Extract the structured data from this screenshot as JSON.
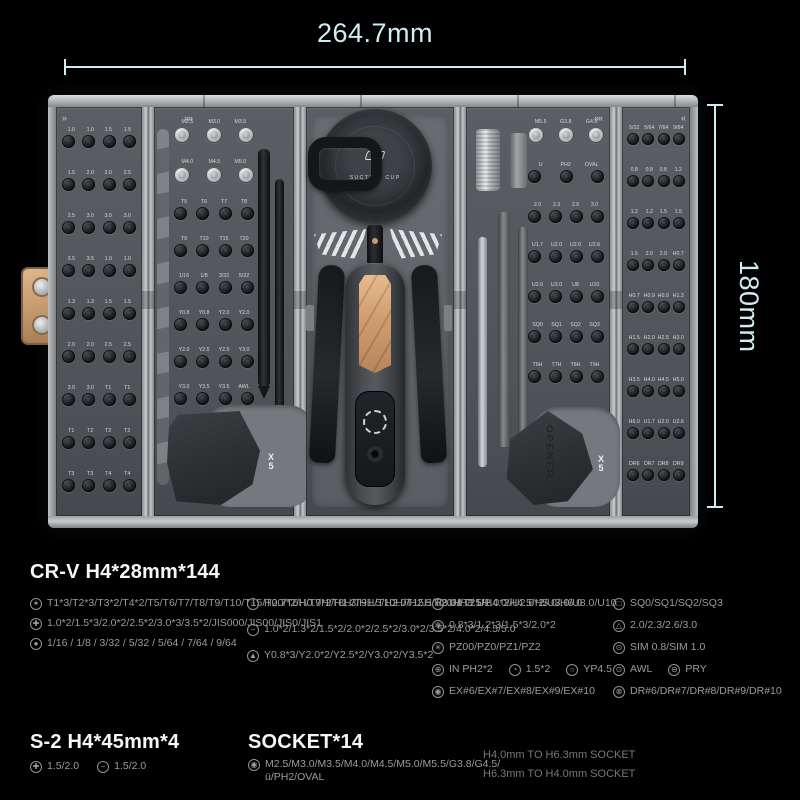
{
  "colors": {
    "accent": "#cfeef2",
    "copper": "#c99a6f",
    "case_gray": "#54585c"
  },
  "annotations": {
    "width_label": "264.7mm",
    "height_label": "180mm"
  },
  "icons": {
    "torx": "✶",
    "phillips": "✚",
    "fraction": "●",
    "hex": "○",
    "slotted": "−",
    "y-type": "▲",
    "u-type": "∪",
    "pentalobe": "✻",
    "pozidriv": "✳",
    "ph-in": "⊕",
    "micro": "◔",
    "yp": "○",
    "external-torx": "◉",
    "square": "□",
    "triangle": "△",
    "sim": "⊙",
    "awl": "⊙",
    "pry": "⊖",
    "dr": "⊗",
    "socket": "◉"
  },
  "case": {
    "marks": {
      "p1": "»",
      "p2": "»»",
      "p4": "««",
      "p5": "«"
    },
    "suction_label": "SUCTION CUP",
    "opener_label": "OPENER",
    "pick_qty": "X5",
    "panel1_rows": [
      "1.0 1.0 1.5 1.5",
      "1.5 2.0 2.0 2.5",
      "2.5 3.0 3.0 3.0",
      "3.5 3.5 1.0 1.0",
      "1.3 1.3 1.5 1.5",
      "2.0 2.0 2.5 2.5",
      "3.0 3.0 T1 T1",
      "T1 T2 T2 T2",
      "T3 T3 T4 T4"
    ],
    "panel2_rows": [
      "M2.5 M3.0 M3.5",
      "M4.0 M4.5 M5.0",
      "T5 T6 T7 T8",
      "T9 T10 T15 T20",
      "1/16 1/8 3/32 5/32",
      "Y0.8 Y0.8 Y2.0 Y2.0",
      "Y2.0 Y2.5 Y2.5 Y3.0",
      "Y3.0 Y3.5 Y3.5 AWL"
    ],
    "panel4_rows": [
      "M5.5 G3.8 G4.5",
      "Ü PH2 OVAL",
      "2.0 2.3 2.6 3.0",
      "U1.7 U2.0 U2.0 U2.6",
      "U2.6 U3.0 U8 U10",
      "SQ0 SQ1 SQ2 SQ3",
      "T6H T7H T8H T9H"
    ],
    "panel5_rows": [
      "5/32 5/64 7/64 9/64",
      "0.8 0.8 0.8 1.2",
      "1.2 1.2 1.5 1.5",
      "1.5 2.0 2.0 H0.7",
      "H0.7 H0.9 H0.9 H1.3",
      "H1.5 H2.0 H2.5 H3.0",
      "H3.5 H4.0 H4.5 H5.0",
      "H6.0 U1.7 U2.0 U2.6",
      "DR6 DR7 DR8 DR9"
    ]
  },
  "specs": {
    "s1": {
      "title": "CR-V H4*28mm*144",
      "col1": [
        {
          "icon": "torx",
          "text": "T1*3/T2*3/T3*2/T4*2/T5/T6/T7/T8/T9/T10/T15/T20/T6H/T7H/T8H/T9H/T10H/T15H/T20H/T25H"
        },
        {
          "icon": "phillips",
          "text": "1.0*2/1.5*3/2.0*2/2.5*2/3.0*3/3.5*2/JIS000/JIS00/JIS0/JIS1"
        },
        {
          "icon": "fraction",
          "text": "1/16 / 1/8 / 3/32 / 5/32 / 5/64 / 7/64 / 9/64"
        }
      ],
      "col2": [
        {
          "icon": "hex",
          "text": "H0.7*2/H0.9*2/H1.3/H1.5/H2.0/H2.5/H3.0/H3.5/H4.0/H4.5/H5.0/H6.0"
        },
        {
          "icon": "slotted",
          "text": "1.0*2/1.3*2/1.5*2/2.0*2/2.5*2/3.0*2/3.5*2/4.0*2/4.5/5.0"
        },
        {
          "icon": "y-type",
          "text": "Y0.8*3/Y2.0*2/Y2.5*2/Y3.0*2/Y3.5*2"
        }
      ],
      "col3": [
        {
          "icon": "u-type",
          "text": "U1.7/ U2.0*2/U2.6*2/U3.0/U8.0/U10"
        },
        {
          "icon": "pentalobe",
          "text": "0.8*3/1.2*3/1.5*3/2.0*2"
        },
        {
          "icon": "pozidriv",
          "text": "PZ00/PZ0/PZ1/PZ2"
        },
        {
          "inline": [
            {
              "icon": "ph-in",
              "text": "IN PH2*2"
            },
            {
              "icon": "micro",
              "text": "1.5*2"
            },
            {
              "icon": "yp",
              "text": "YP4.5"
            }
          ]
        },
        {
          "icon": "external-torx",
          "text": "EX#6/EX#7/EX#8/EX#9/EX#10"
        }
      ],
      "col4": [
        {
          "icon": "square",
          "text": "SQ0/SQ1/SQ2/SQ3"
        },
        {
          "icon": "triangle",
          "text": "2.0/2.3/2.6/3.0"
        },
        {
          "icon": "sim",
          "text": "SIM 0.8/SIM 1.0"
        },
        {
          "inline": [
            {
              "icon": "awl",
              "text": "AWL"
            },
            {
              "icon": "pry",
              "text": "PRY"
            }
          ]
        },
        {
          "icon": "dr",
          "text": "DR#6/DR#7/DR#8/DR#9/DR#10"
        }
      ]
    },
    "s2": {
      "title": "S-2 H4*45mm*4",
      "items": [
        {
          "icon": "phillips",
          "text": "1.5/2.0"
        },
        {
          "icon": "slotted",
          "text": "1.5/2.0"
        }
      ]
    },
    "s3": {
      "title": "SOCKET*14",
      "items": [
        {
          "icon": "socket",
          "text": "M2.5/M3.0/M3.5/M4.0/M4.5/M5.0/M5.5/G3.8/G4.5/ü/PH2/OVAL"
        }
      ]
    },
    "note": {
      "line1": "H4.0mm TO H6.3mm SOCKET",
      "line2": "H6.3mm TO H4.0mm SOCKET"
    }
  }
}
